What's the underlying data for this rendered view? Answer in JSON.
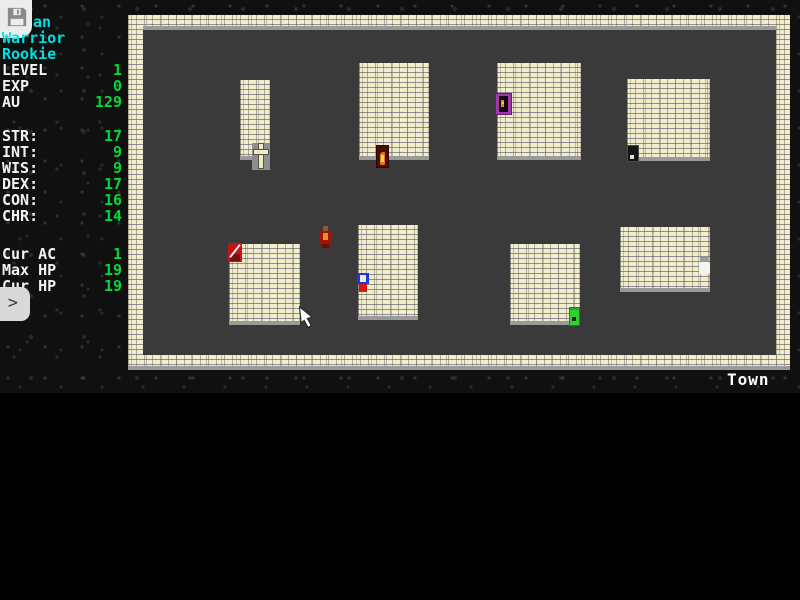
{
  "sidebar": {
    "save_icon": "floppy-disk-icon",
    "expand_icon": ">",
    "character": {
      "name_visible": "an",
      "class": "Warrior",
      "rank": "Rookie"
    },
    "progress": [
      {
        "label": "LEVEL",
        "value": "1"
      },
      {
        "label": "EXP",
        "value": "0"
      },
      {
        "label": "AU",
        "value": "129"
      }
    ],
    "attributes": [
      {
        "label": "STR:",
        "value": "17"
      },
      {
        "label": "INT:",
        "value": "9"
      },
      {
        "label": "WIS:",
        "value": "9"
      },
      {
        "label": "DEX:",
        "value": "17"
      },
      {
        "label": "CON:",
        "value": "16"
      },
      {
        "label": "CHR:",
        "value": "14"
      }
    ],
    "vitals": [
      {
        "label": "Cur AC",
        "value": "1"
      },
      {
        "label": "Max HP",
        "value": "19"
      },
      {
        "label": "Cur HP",
        "value": "19"
      }
    ]
  },
  "map": {
    "area_label": "Town",
    "walls": [
      {
        "side": "top",
        "x": 128,
        "y": 15,
        "w": 662,
        "h": 15
      },
      {
        "side": "left",
        "x": 128,
        "y": 15,
        "w": 15,
        "h": 355
      },
      {
        "side": "right",
        "x": 776,
        "y": 15,
        "w": 14,
        "h": 355
      },
      {
        "side": "bottom",
        "x": 128,
        "y": 355,
        "w": 662,
        "h": 15
      }
    ],
    "buildings": [
      {
        "x": 240,
        "y": 80,
        "w": 30,
        "h": 80
      },
      {
        "x": 359,
        "y": 63,
        "w": 70,
        "h": 97
      },
      {
        "x": 497,
        "y": 63,
        "w": 84,
        "h": 97
      },
      {
        "x": 627,
        "y": 79,
        "w": 83,
        "h": 82
      },
      {
        "x": 229,
        "y": 244,
        "w": 71,
        "h": 81
      },
      {
        "x": 358,
        "y": 225,
        "w": 60,
        "h": 95
      },
      {
        "x": 510,
        "y": 244,
        "w": 70,
        "h": 81
      },
      {
        "x": 620,
        "y": 227,
        "w": 90,
        "h": 65
      }
    ],
    "entities": [
      {
        "type": "cross-marker",
        "x": 252,
        "y": 143,
        "interactable": true
      },
      {
        "type": "door-flame",
        "x": 376,
        "y": 145,
        "interactable": true
      },
      {
        "type": "door-purple",
        "x": 495,
        "y": 93,
        "interactable": true
      },
      {
        "type": "door-black",
        "x": 627,
        "y": 145,
        "interactable": true
      },
      {
        "type": "flag-red",
        "x": 228,
        "y": 243,
        "interactable": true
      },
      {
        "type": "door-green",
        "x": 569,
        "y": 307,
        "interactable": true
      },
      {
        "type": "npc-white",
        "x": 698,
        "y": 257,
        "interactable": true
      },
      {
        "type": "npc-imp",
        "x": 319,
        "y": 226,
        "interactable": true
      },
      {
        "type": "player-blue",
        "x": 357,
        "y": 271,
        "interactable": true
      },
      {
        "type": "mouse-cursor",
        "x": 299,
        "y": 305,
        "interactable": false
      }
    ]
  },
  "colors": {
    "cyan_text": "#00e0e0",
    "stat_green": "#00d93a",
    "label_white": "#f2f2f2",
    "floor": "#3a3a3b",
    "brick": "#f2eecb",
    "door_green": "#2fd02f",
    "door_purple": "#a03aa6",
    "door_flame": "#4a0e06"
  }
}
